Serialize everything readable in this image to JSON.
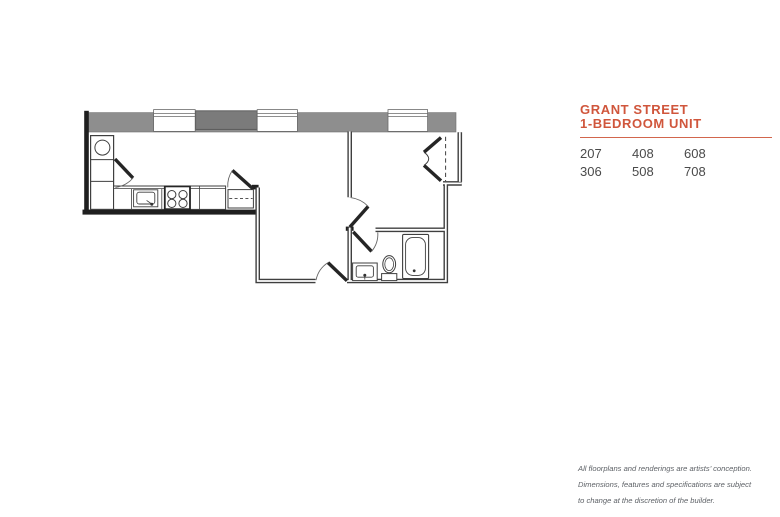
{
  "header": {
    "title_line1": "GRANT STREET",
    "title_line2": "1-BEDROOM UNIT",
    "accent_color": "#d0563c",
    "rule_color": "#d2664d"
  },
  "units": {
    "rows": [
      [
        "207",
        "408",
        "608"
      ],
      [
        "306",
        "508",
        "708"
      ]
    ]
  },
  "disclaimer": {
    "lines": [
      "All floorplans and renderings are artists’ conception.",
      "Dimensions, features and specifications are subject",
      "to change at the discretion of the builder."
    ]
  },
  "floorplan": {
    "description": "1-bedroom unit floor plan drawing",
    "wall_band_color": "#8e8e8e",
    "dark_wall_panel_color": "#7b7b7b",
    "line_color": "#3f3f3f",
    "fixtures": [
      "washer-appliance",
      "kitchen-counter",
      "kitchen-sink",
      "stove",
      "pantry-closet",
      "bifold-closet",
      "bathtub",
      "toilet",
      "vanity-sink"
    ],
    "door_count": 5,
    "window_count": 3
  }
}
